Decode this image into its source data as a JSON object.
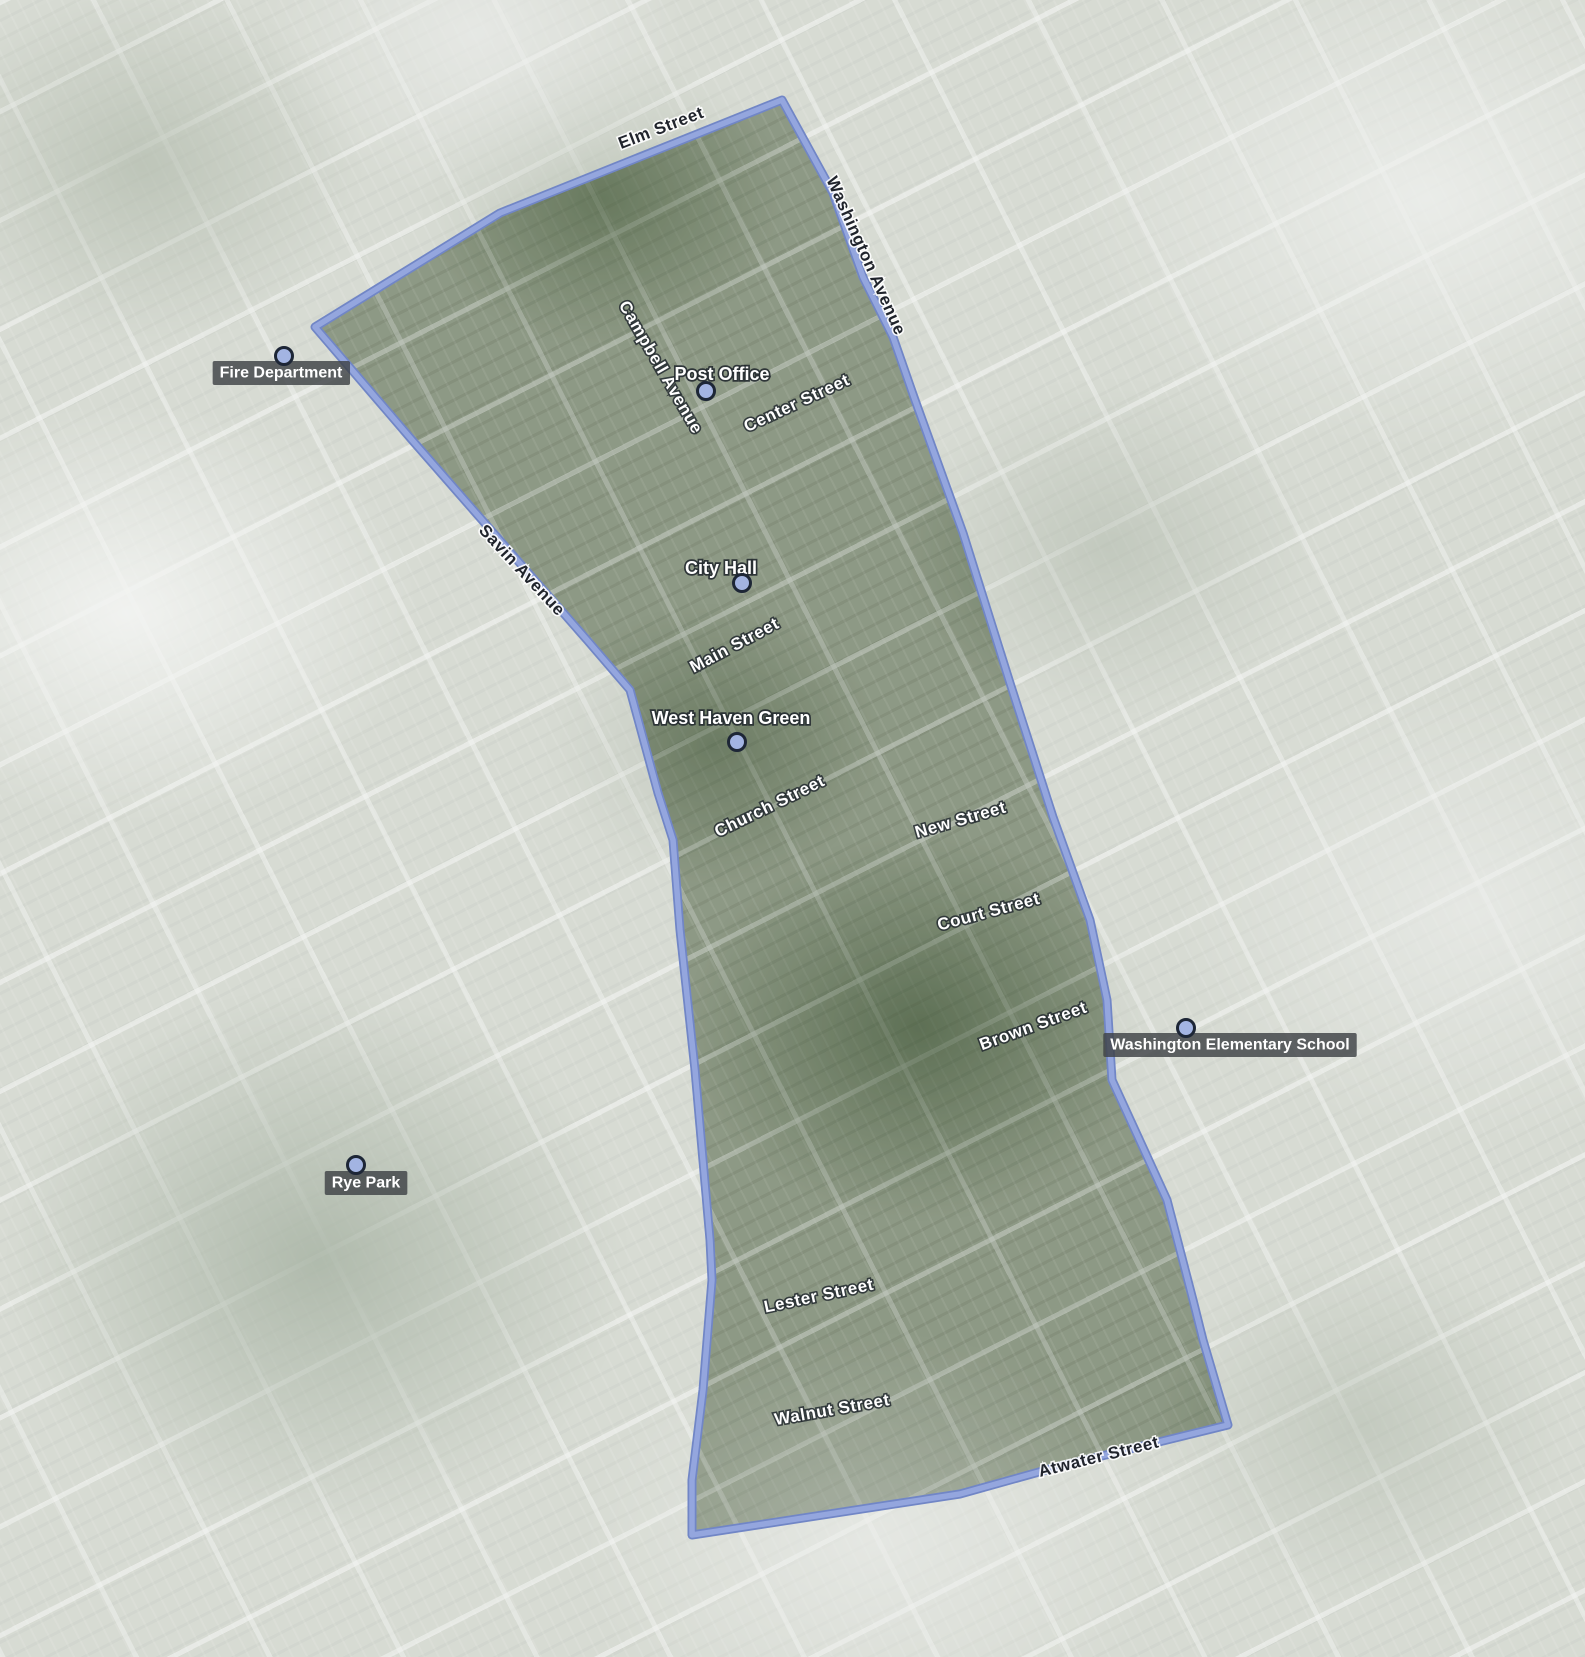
{
  "map": {
    "type": "satellite-map-with-boundary-overlay",
    "canvas": {
      "width": 1585,
      "height": 1657
    },
    "colors": {
      "boundary_outer": "#7186c6",
      "boundary_inner": "#94a6de",
      "outside_fade": "rgba(255,255,255,0.56)",
      "inside_tint": "rgba(24,50,18,0.16)",
      "marker_fill": "#a3b4e2",
      "marker_stroke": "#1d2636",
      "chip_background": "rgba(62,66,70,0.82)",
      "street_label_inside": "#ffffff",
      "street_label_outside": "#20242c"
    },
    "boundary_polygon": [
      [
        782,
        100
      ],
      [
        833,
        193
      ],
      [
        863,
        277
      ],
      [
        893,
        337
      ],
      [
        915,
        400
      ],
      [
        963,
        533
      ],
      [
        1010,
        683
      ],
      [
        1053,
        817
      ],
      [
        1090,
        920
      ],
      [
        1107,
        1000
      ],
      [
        1112,
        1080
      ],
      [
        1167,
        1200
      ],
      [
        1193,
        1300
      ],
      [
        1203,
        1340
      ],
      [
        1228,
        1425
      ],
      [
        1057,
        1467
      ],
      [
        960,
        1494
      ],
      [
        692,
        1535
      ],
      [
        692,
        1480
      ],
      [
        703,
        1390
      ],
      [
        712,
        1280
      ],
      [
        710,
        1240
      ],
      [
        695,
        1070
      ],
      [
        680,
        930
      ],
      [
        673,
        840
      ],
      [
        658,
        793
      ],
      [
        630,
        690
      ],
      [
        587,
        640
      ],
      [
        412,
        440
      ],
      [
        315,
        327
      ],
      [
        500,
        213
      ]
    ],
    "street_labels": [
      {
        "text": "Elm Street",
        "x": 663,
        "y": 133,
        "rotation": -21,
        "style": "outside"
      },
      {
        "text": "Washington Avenue",
        "x": 861,
        "y": 258,
        "rotation": 66,
        "style": "outside"
      },
      {
        "text": "Campbell Avenue",
        "x": 656,
        "y": 370,
        "rotation": 60,
        "style": "inside"
      },
      {
        "text": "Center Street",
        "x": 799,
        "y": 408,
        "rotation": -25,
        "style": "inside"
      },
      {
        "text": "Savin Avenue",
        "x": 518,
        "y": 574,
        "rotation": 47,
        "style": "outside"
      },
      {
        "text": "Main Street",
        "x": 737,
        "y": 650,
        "rotation": -28,
        "style": "inside"
      },
      {
        "text": "Church Street",
        "x": 772,
        "y": 811,
        "rotation": -26,
        "style": "inside"
      },
      {
        "text": "New Street",
        "x": 962,
        "y": 825,
        "rotation": -16,
        "style": "inside"
      },
      {
        "text": "Court Street",
        "x": 990,
        "y": 917,
        "rotation": -15,
        "style": "inside"
      },
      {
        "text": "Brown Street",
        "x": 1035,
        "y": 1031,
        "rotation": -20,
        "style": "inside"
      },
      {
        "text": "Lester Street",
        "x": 820,
        "y": 1301,
        "rotation": -12,
        "style": "inside"
      },
      {
        "text": "Walnut Street",
        "x": 833,
        "y": 1415,
        "rotation": -10,
        "style": "inside"
      },
      {
        "text": "Atwater Street",
        "x": 1100,
        "y": 1462,
        "rotation": -14,
        "style": "outside"
      }
    ],
    "poi_labels": [
      {
        "text": "Fire Department",
        "label_x": 281,
        "label_y": 372,
        "marker_x": 284,
        "marker_y": 356,
        "style": "chip"
      },
      {
        "text": "Post Office",
        "label_x": 722,
        "label_y": 374,
        "marker_x": 706,
        "marker_y": 391,
        "style": "plain"
      },
      {
        "text": "City Hall",
        "label_x": 721,
        "label_y": 568,
        "marker_x": 742,
        "marker_y": 583,
        "style": "plain"
      },
      {
        "text": "West Haven Green",
        "label_x": 731,
        "label_y": 718,
        "marker_x": 737,
        "marker_y": 742,
        "style": "plain"
      },
      {
        "text": "Washington Elementary School",
        "label_x": 1230,
        "label_y": 1044,
        "marker_x": 1186,
        "marker_y": 1028,
        "style": "chip"
      },
      {
        "text": "Rye Park",
        "label_x": 366,
        "label_y": 1182,
        "marker_x": 356,
        "marker_y": 1165,
        "style": "chip"
      }
    ]
  }
}
